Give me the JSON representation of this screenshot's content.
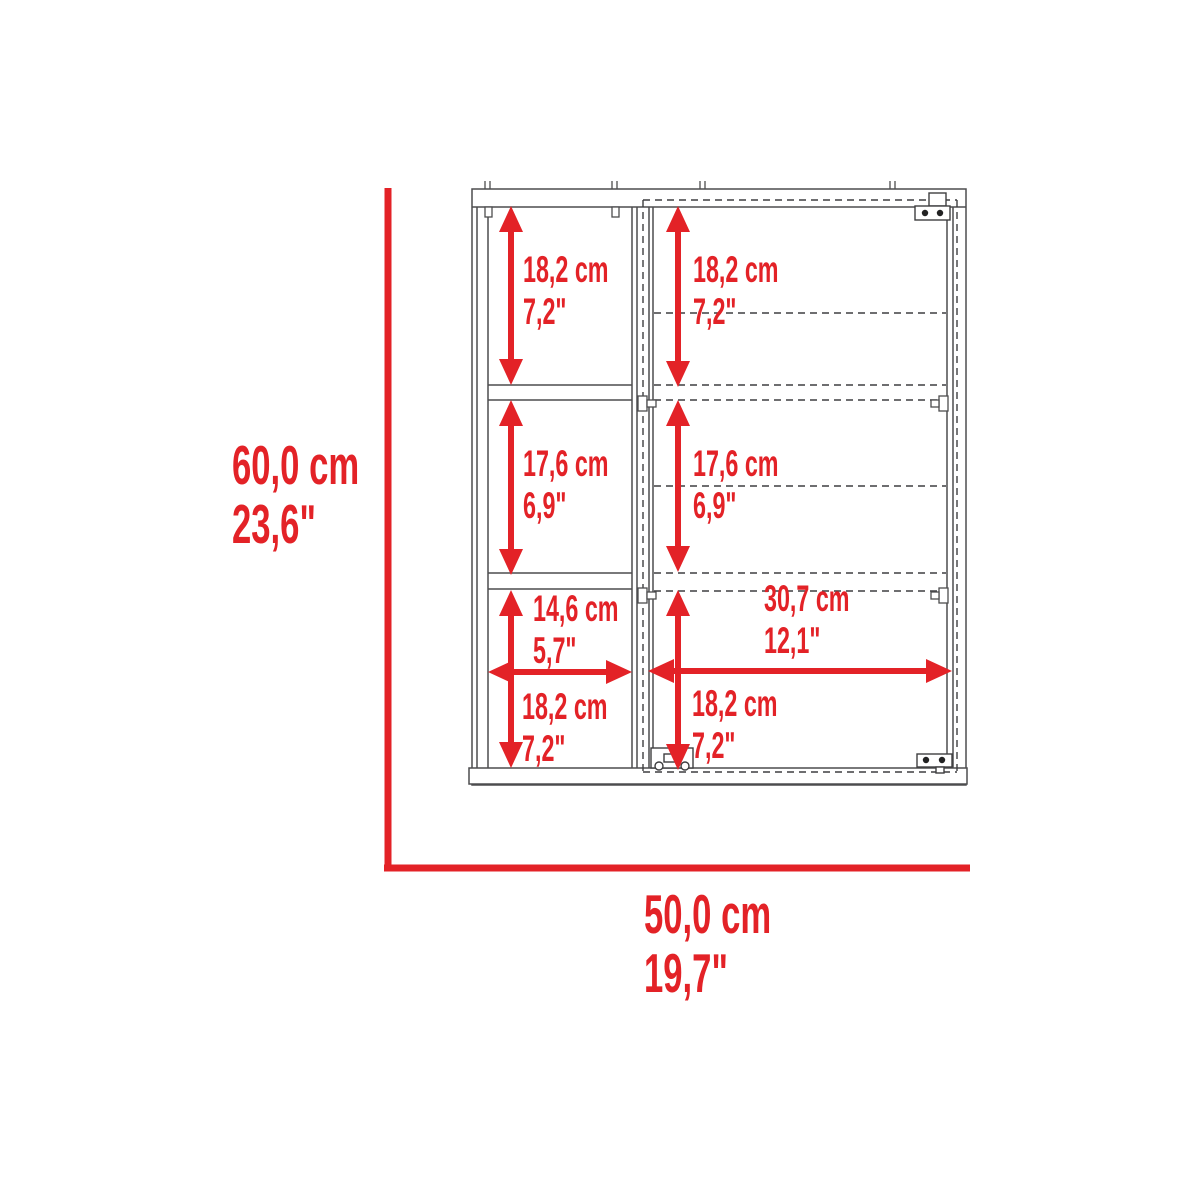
{
  "accent_color": "#e32227",
  "line_color": "#4d4d4f",
  "overall": {
    "height": {
      "cm": "60,0 cm",
      "in": "23,6\""
    },
    "width": {
      "cm": "50,0 cm",
      "in": "19,7\""
    }
  },
  "labels": {
    "top_left_shelf": {
      "cm": "18,2 cm",
      "in": "7,2\""
    },
    "top_right_shelf": {
      "cm": "18,2 cm",
      "in": "7,2\""
    },
    "mid_left_shelf": {
      "cm": "17,6 cm",
      "in": "6,9\""
    },
    "mid_right_shelf": {
      "cm": "17,6 cm",
      "in": "6,9\""
    },
    "left_inner_width": {
      "cm": "14,6 cm",
      "in": "5,7\""
    },
    "right_inner_width": {
      "cm": "30,7 cm",
      "in": "12,1\""
    },
    "bottom_left_shelf": {
      "cm": "18,2 cm",
      "in": "7,2\""
    },
    "bottom_right_shelf": {
      "cm": "18,2 cm",
      "in": "7,2\""
    }
  }
}
